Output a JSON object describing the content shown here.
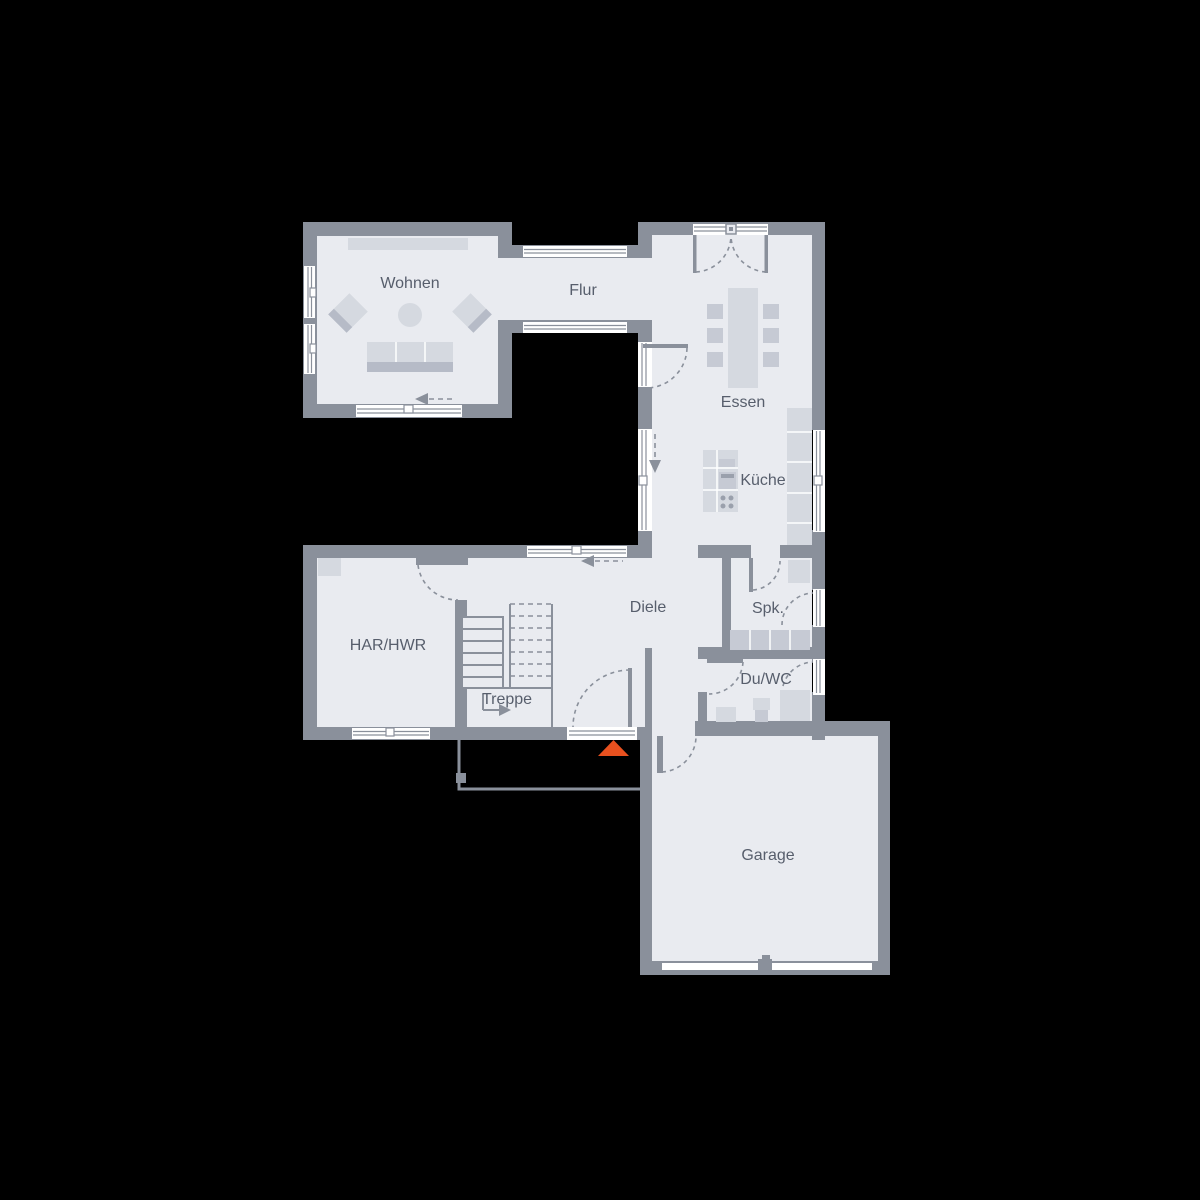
{
  "plan": {
    "rooms": [
      {
        "id": "wohnen",
        "label": "Wohnen"
      },
      {
        "id": "flur",
        "label": "Flur"
      },
      {
        "id": "essen",
        "label": "Essen"
      },
      {
        "id": "kueche",
        "label": "Küche"
      },
      {
        "id": "diele",
        "label": "Diele"
      },
      {
        "id": "spk",
        "label": "Spk."
      },
      {
        "id": "duwc",
        "label": "Du/WC"
      },
      {
        "id": "treppe",
        "label": "Treppe"
      },
      {
        "id": "harhwr",
        "label": "HAR/HWR"
      },
      {
        "id": "garage",
        "label": "Garage"
      }
    ],
    "colors": {
      "background": "#000000",
      "wall": "#8A909B",
      "floor": "#E9EBF0",
      "furniture": "#D5D9E0",
      "label": "#575E6C",
      "window": "#FFFFFF",
      "entrance_marker": "#E8511F"
    }
  }
}
